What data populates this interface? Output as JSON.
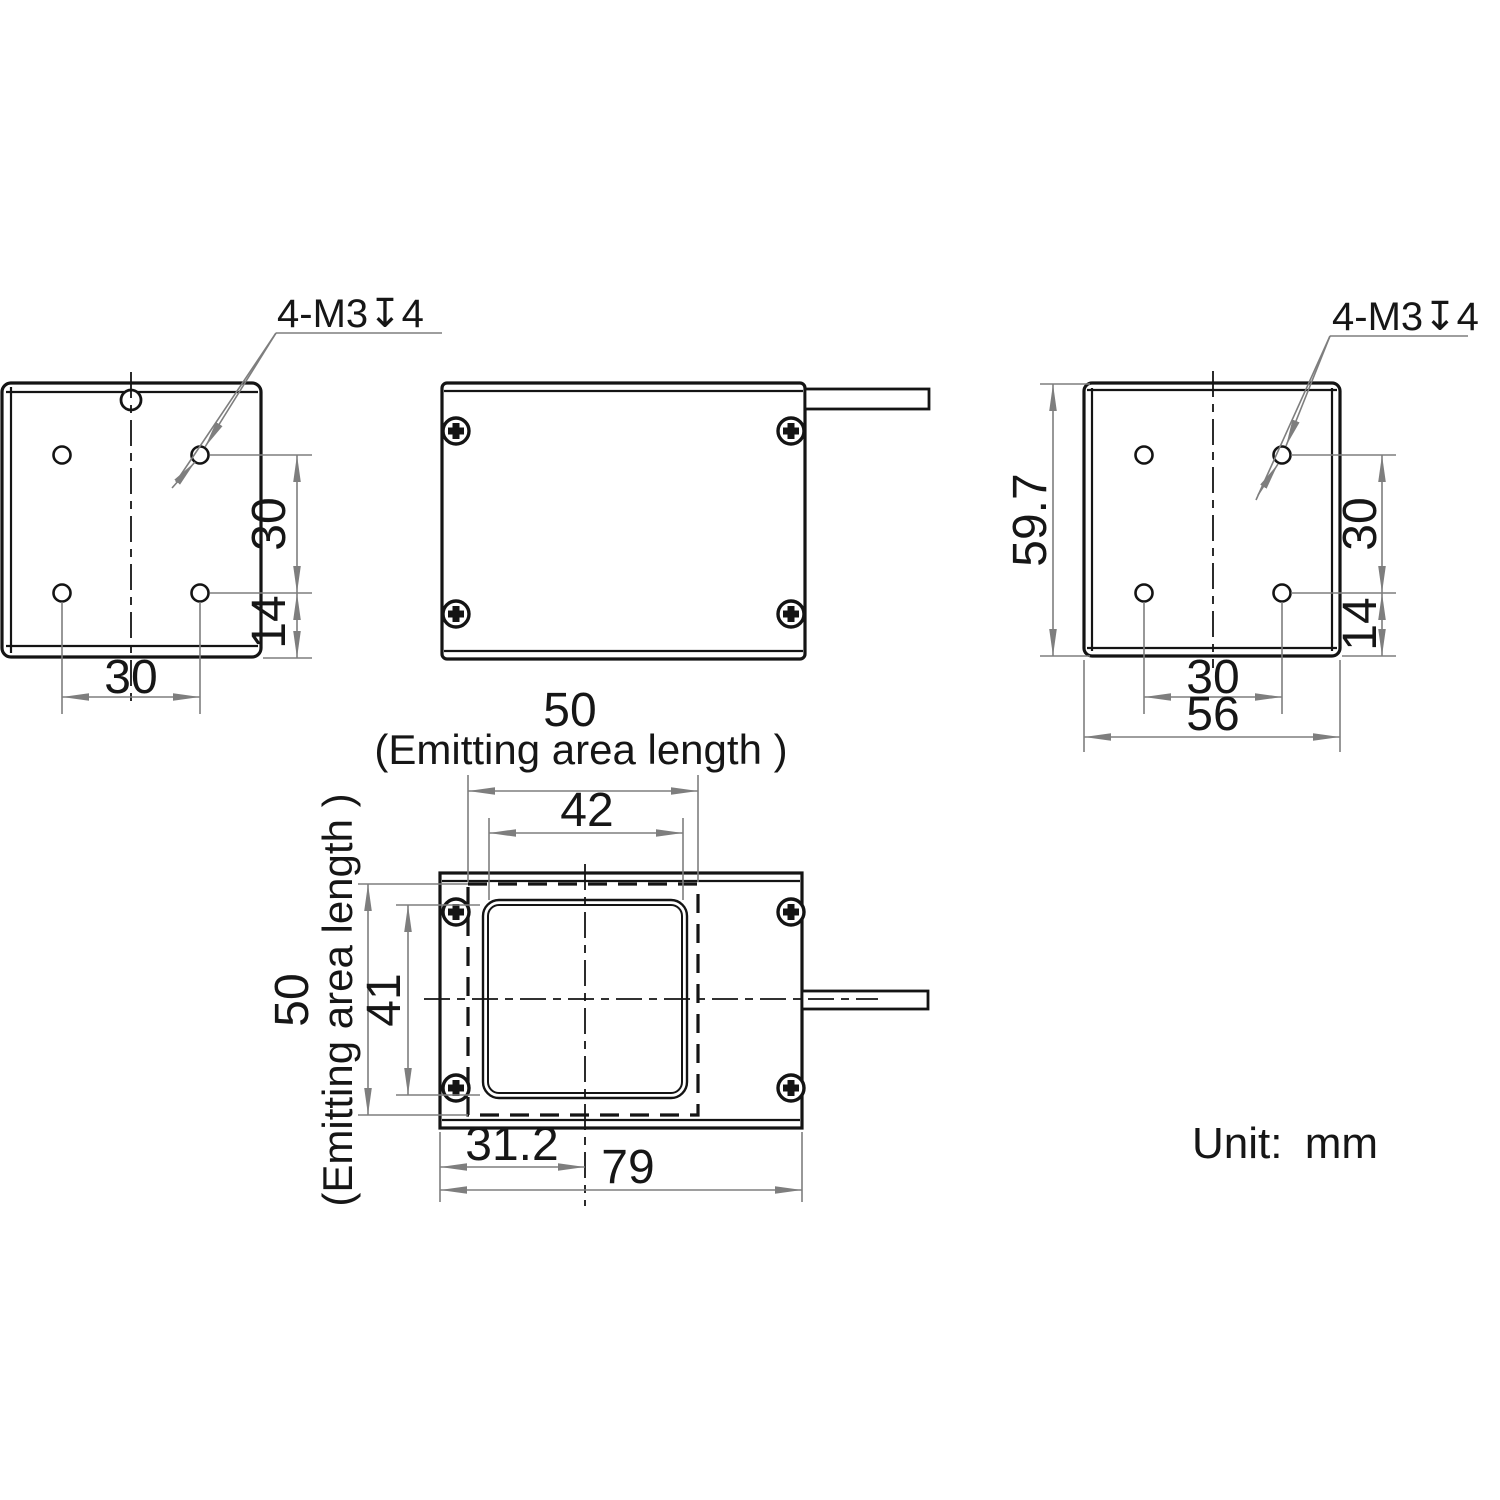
{
  "note": {
    "unit": "Unit: mm"
  },
  "views": {
    "left_side": {
      "callout": "4-M3↧4",
      "hole_pitch_vertical": "30",
      "hole_edge_offset": "14",
      "hole_pitch_horizontal": "30"
    },
    "right_side": {
      "callout": "4-M3↧4",
      "overall_height": "59.7",
      "hole_pitch_vertical": "30",
      "hole_edge_offset": "14",
      "hole_pitch_horizontal": "30",
      "overall_width": "56"
    },
    "front": {
      "emitting_width": "50",
      "emitting_width_note": "(Emitting area length )",
      "window_width": "42",
      "window_height": "41",
      "emitting_height": "50",
      "emitting_height_note": "(Emitting area length )",
      "center_offset": "31.2",
      "overall_width": "79"
    }
  }
}
